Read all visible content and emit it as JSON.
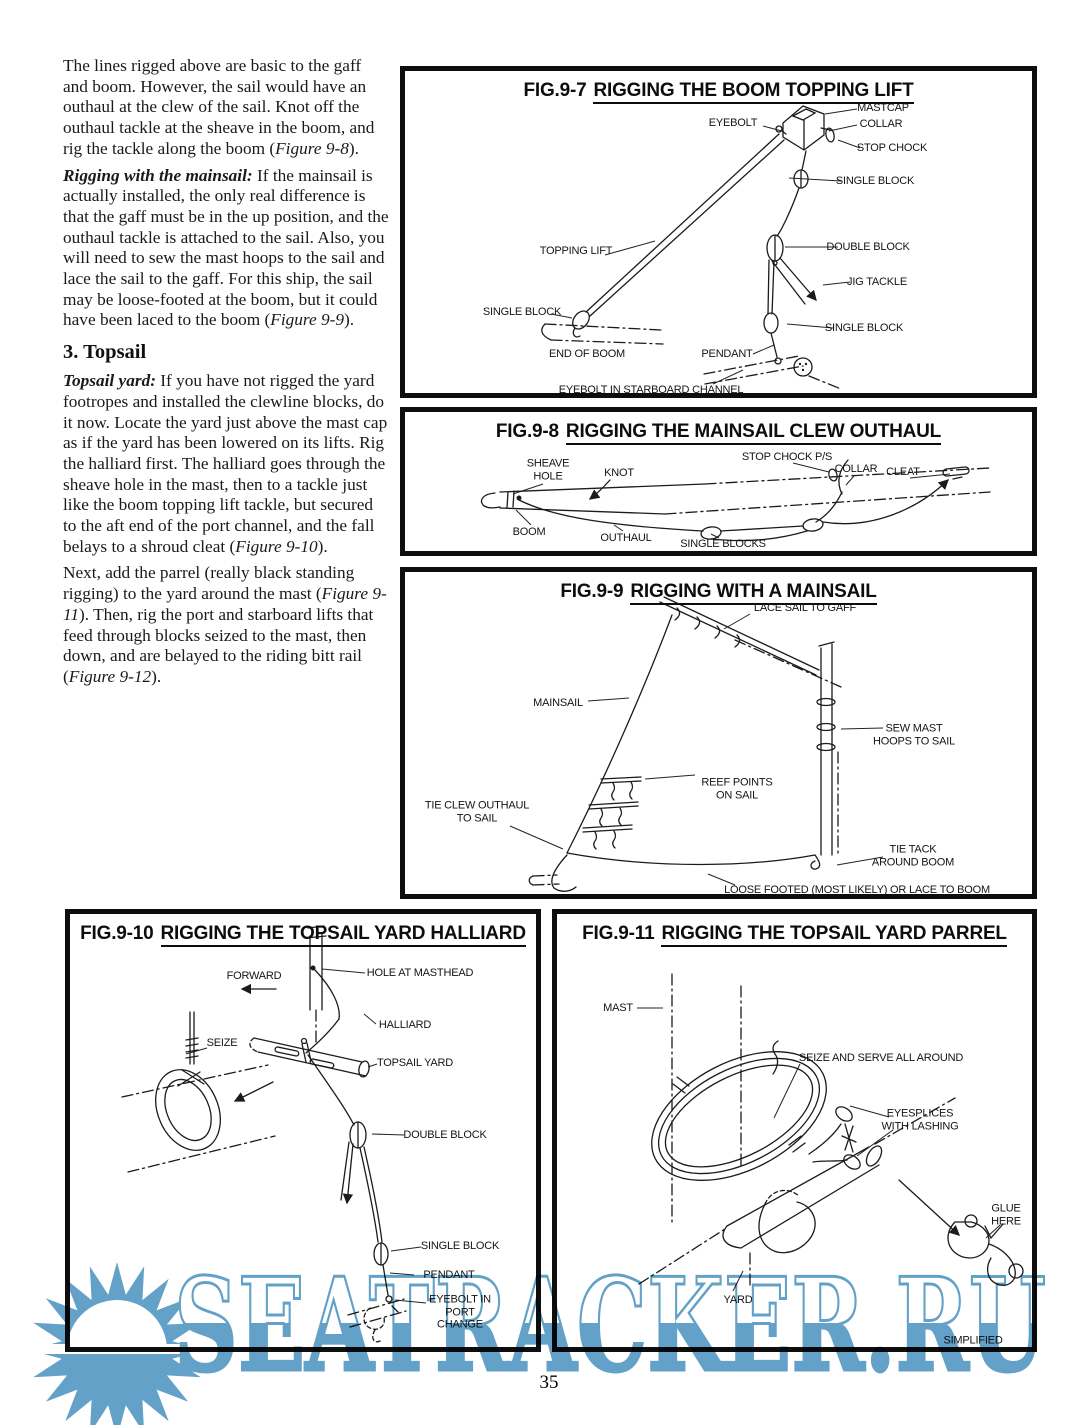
{
  "page": {
    "number": "35"
  },
  "watermark": {
    "text": "SEATRACKER.RU",
    "color": "#63a1c8"
  },
  "article": {
    "p1": [
      "The lines rigged above are basic to the gaff and boom. However, the sail would have an outhaul at the clew of the sail. Knot off the outhaul tackle at the sheave in the boom, and rig the tackle along the boom (",
      "Figure 9-8",
      ")."
    ],
    "p2": [
      "Rigging with the mainsail:",
      " If the mainsail is actually installed, the only real difference is that the gaff must be in the up position, and the outhaul tackle is attached to the sail. Also, you will need to sew the mast hoops to the sail and lace the sail to the gaff. For this ship, the sail may be loose-footed at the boom, but it could have been laced to the boom (",
      "Figure 9-9",
      ")."
    ],
    "heading": "3. Topsail",
    "p3": [
      "Topsail yard:",
      " If you have not rigged the yard footropes and installed the clewline blocks, do it now. Locate the yard just above the mast cap as if the yard has been lowered on its lifts. Rig the halliard first. The halliard goes through the sheave hole in the mast, then to a tackle just like the boom topping lift tackle, but secured to the aft end of the port channel, and the fall belays to a shroud cleat (",
      "Figure 9-10",
      ")."
    ],
    "p4": [
      "Next, add the parrel (really black standing rigging) to the yard around the mast (",
      "Figure 9-11",
      "). Then, rig the port and starboard lifts that feed through blocks seized to the mast, then down, and are belayed to the riding bitt rail (",
      "Figure 9-12",
      ")."
    ]
  },
  "figures": {
    "fig97": {
      "prefix": "FIG.9-7",
      "title": "RIGGING THE BOOM TOPPING LIFT",
      "labels": {
        "eyebolt": "EYEBOLT",
        "mastcap": "MASTCAP",
        "collar": "COLLAR",
        "stop_chock": "STOP CHOCK",
        "single_block_top": "SINGLE BLOCK",
        "topping_lift": "TOPPING LIFT",
        "double_block": "DOUBLE BLOCK",
        "jig_tackle": "JIG TACKLE",
        "single_block_right": "SINGLE BLOCK",
        "single_block_left": "SINGLE BLOCK",
        "end_of_boom": "END OF BOOM",
        "pendant": "PENDANT",
        "eyebolt_channel": "EYEBOLT IN STARBOARD CHANNEL"
      }
    },
    "fig98": {
      "prefix": "FIG.9-8",
      "title": "RIGGING THE MAINSAIL CLEW OUTHAUL",
      "labels": {
        "sheave_hole": [
          "SHEAVE",
          "HOLE"
        ],
        "knot": "KNOT",
        "stop_chock_ps": "STOP CHOCK P/S",
        "collar": "COLLAR",
        "cleat": "CLEAT",
        "boom": "BOOM",
        "outhaul": "OUTHAUL",
        "single_blocks": "SINGLE BLOCKS"
      }
    },
    "fig99": {
      "prefix": "FIG.9-9",
      "title": "RIGGING WITH A MAINSAIL",
      "labels": {
        "lace": "LACE SAIL TO GAFF",
        "mainsail": "MAINSAIL",
        "sew_mast": [
          "SEW MAST",
          "HOOPS TO SAIL"
        ],
        "reef_points": [
          "REEF POINTS",
          "ON SAIL"
        ],
        "tie_clew": [
          "TIE CLEW OUTHAUL",
          "TO SAIL"
        ],
        "tie_tack": [
          "TIE TACK",
          "AROUND BOOM"
        ],
        "loose_footed": "LOOSE FOOTED (MOST LIKELY) OR LACE TO BOOM"
      }
    },
    "fig910": {
      "prefix": "FIG.9-10",
      "title": "RIGGING THE TOPSAIL YARD HALLIARD",
      "labels": {
        "forward": "FORWARD",
        "hole_masthead": "HOLE AT MASTHEAD",
        "seize": "SEIZE",
        "halliard": "HALLIARD",
        "topsail_yard": "TOPSAIL YARD",
        "double_block": "DOUBLE BLOCK",
        "single_block": "SINGLE BLOCK",
        "pendant": "PENDANT",
        "eyebolt_port": [
          "EYEBOLT IN",
          "PORT",
          "CHANGE"
        ]
      }
    },
    "fig911": {
      "prefix": "FIG.9-11",
      "title": "RIGGING THE TOPSAIL YARD PARREL",
      "labels": {
        "mast": "MAST",
        "seize_serve": "SEIZE AND SERVE ALL AROUND",
        "eyesplices": [
          "EYESPLICES",
          "WITH LASHING"
        ],
        "glue_here": [
          "GLUE",
          "HERE"
        ],
        "yard": "YARD",
        "simplified": "SIMPLIFIED"
      }
    }
  }
}
